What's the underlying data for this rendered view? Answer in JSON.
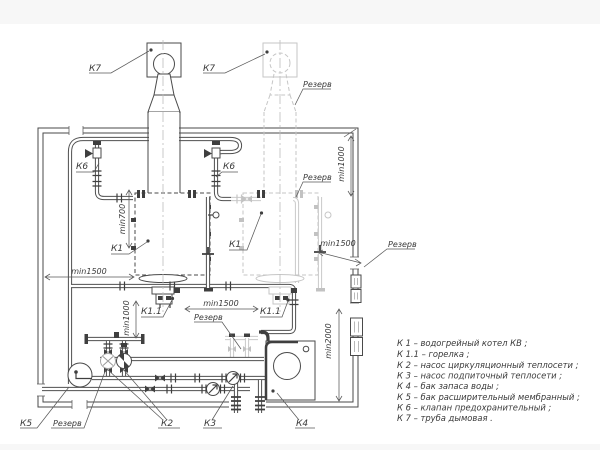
{
  "labels": {
    "k7": "К7",
    "k6": "К6",
    "k1": "К1",
    "k11": "К1.1",
    "k2": "К2",
    "k3": "К3",
    "k4": "К4",
    "k5": "К5",
    "reserve": "Резерв"
  },
  "dims": {
    "d700": "min700",
    "d1000": "min1000",
    "d1500": "min1500",
    "d2000": "min2000"
  },
  "legend": {
    "items": [
      "К 1 –  водогрейный котел КВ ;",
      "К 1.1 –  горелка ;",
      "К 2 –  насос циркуляционный теплосети ;",
      "К 3 –  насос подпиточный теплосети ;",
      "К 4 –  бак запаса воды ;",
      "К 5 –  бак расширительный мембранный ;",
      "К 6 –  клапан предохранительный ;",
      "К 7 –  труба дымовая ."
    ]
  },
  "colors": {
    "line": "#4a4a4a",
    "reserve_faint": "#c6c6c6",
    "background": "#ffffff"
  }
}
